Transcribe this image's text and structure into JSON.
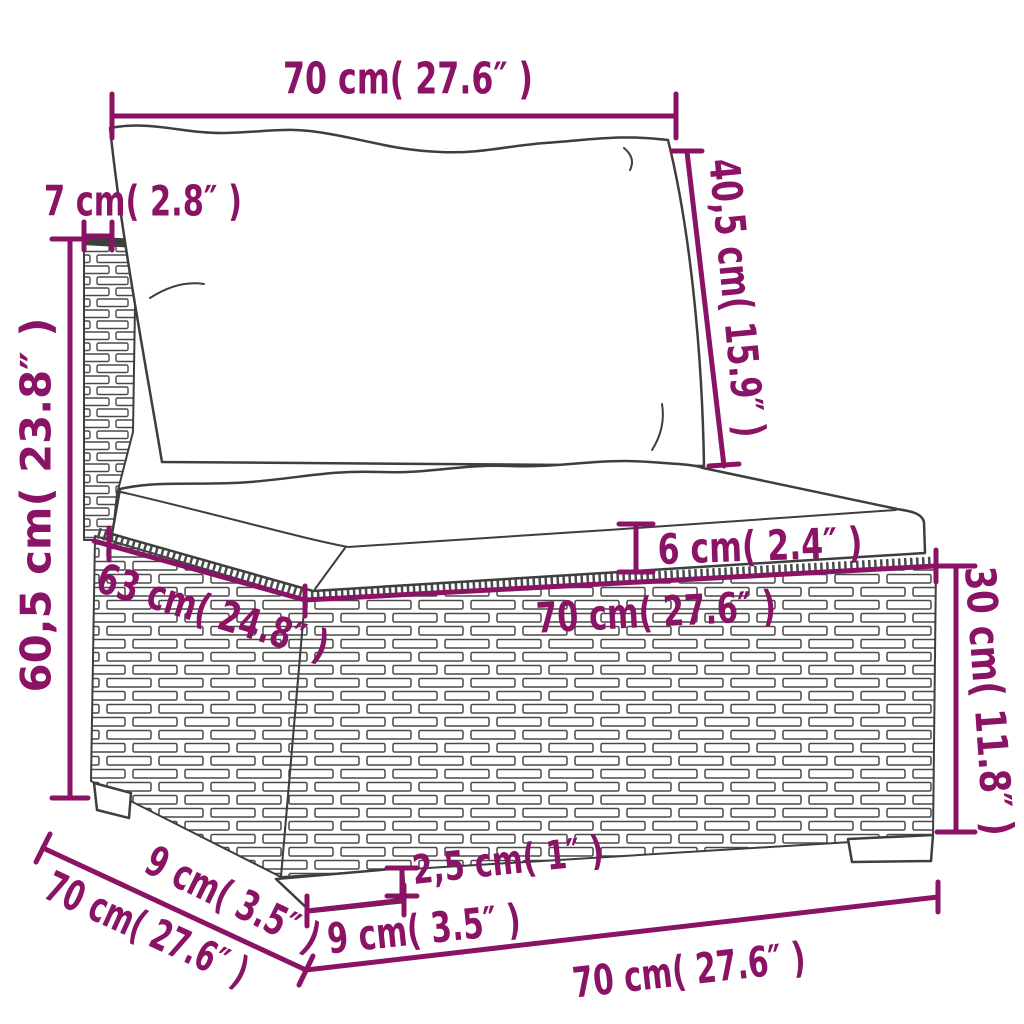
{
  "diagram": {
    "description": "Dimension drawing of a poly rattan sofa middle section with back cushion and seat cushion",
    "unit_style": "centimetres with inches in parentheses"
  },
  "colors": {
    "dimension": "#8A1365",
    "drawing_line": "#3e3e3e",
    "background": "#ffffff"
  },
  "dimensions": {
    "top_width": "70 cm( 27.6″ )",
    "back_cushion_height": "40,5 cm( 15.9″ )",
    "backrest_thickness": "7 cm( 2.8″ )",
    "overall_height": "60,5 cm( 23.8″ )",
    "seat_cushion_thickness": "6 cm( 2.4″ )",
    "seat_width": "70 cm( 27.6″ )",
    "seat_depth": "63 cm( 24.8″ )",
    "base_height": "30 cm( 11.8″ )",
    "leg_height": "2,5 cm( 1″ )",
    "leg_width": "9 cm( 3.5″ )",
    "leg_depth": "9 cm( 3.5″ )",
    "overall_depth": "70 cm( 27.6″ )",
    "overall_width_bottom": "70 cm( 27.6″ )"
  }
}
